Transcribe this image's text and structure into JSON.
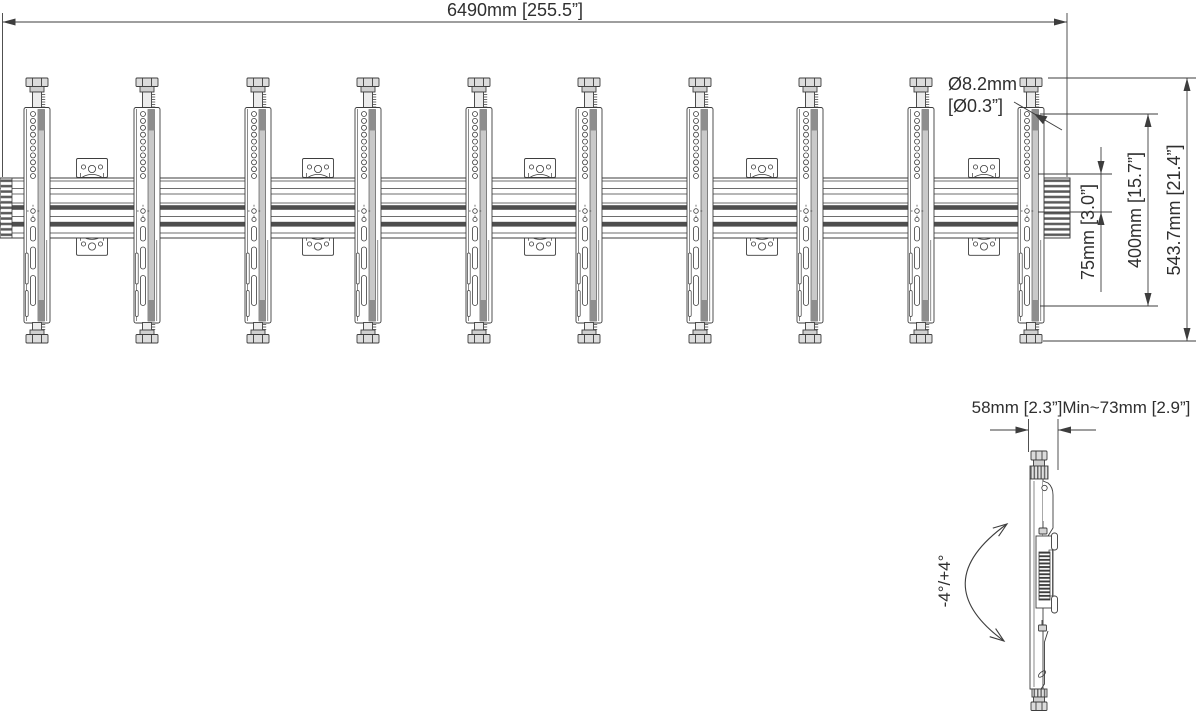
{
  "drawing": {
    "type": "wall-mount-rail-technical-drawing",
    "annotations": {
      "total_width": "6490mm [255.5”]",
      "hole_diameter_line1": "Ø8.2mm",
      "hole_diameter_line2": "[Ø0.3”]",
      "hole_offset": "75mm [3.0”]",
      "vesa_height": "400mm [15.7”]",
      "bracket_height": "543.7mm [21.4”]",
      "mount_depth_range": "58mm [2.3”]Min~73mm [2.9”]",
      "tilt_range": "-4°/+4°"
    },
    "component_counts": {
      "brackets": 10,
      "wall_plates": 5
    },
    "colors": {
      "line": "#3d3d3d",
      "dark_band": "#4e4e4e",
      "light_fill": "#dcdcdc",
      "background": "#ffffff"
    }
  }
}
